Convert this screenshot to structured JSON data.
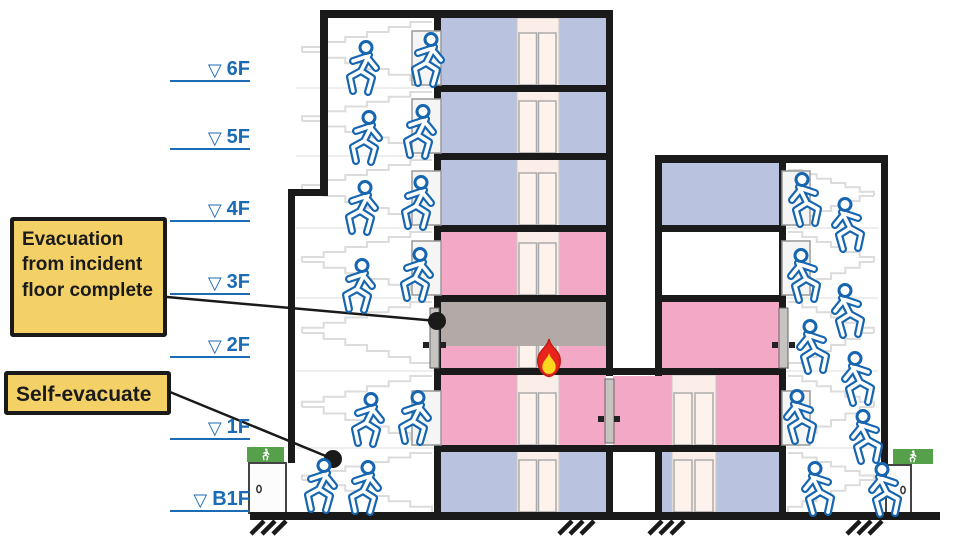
{
  "colors": {
    "floor_blue": "#B9C3E0",
    "floor_pink": "#F3A8C5",
    "smoke_gray": "#B2AAA6",
    "shaft_pink": "#FBEDE8",
    "door_pale": "#FDF2EC",
    "callout_yellow": "#F4D166",
    "person_blue": "#1565B0",
    "label_blue": "#1B6BB5",
    "exit_green": "#56A04B",
    "fire_red": "#E8251D",
    "fire_yellow": "#FFD71F",
    "ink": "#1A1A1A",
    "stair_gray": "#DCDCDC"
  },
  "callouts": {
    "incident": {
      "text": "Evacuation from incident floor complete"
    },
    "self": {
      "text": "Self-evacuate"
    }
  },
  "floor_labels": {
    "marker": "▽",
    "items": [
      {
        "label": "6F"
      },
      {
        "label": "5F"
      },
      {
        "label": "4F"
      },
      {
        "label": "3F"
      },
      {
        "label": "2F"
      },
      {
        "label": "1F"
      },
      {
        "label": "B1F"
      }
    ]
  },
  "icons": {
    "runner": "running-person evacuation pictogram (blue outline)",
    "exit_sign": "green emergency-exit sign with white runner",
    "fire": "red and yellow flame on incident floor",
    "level_marker": "inverted open triangle floor-level marker"
  }
}
